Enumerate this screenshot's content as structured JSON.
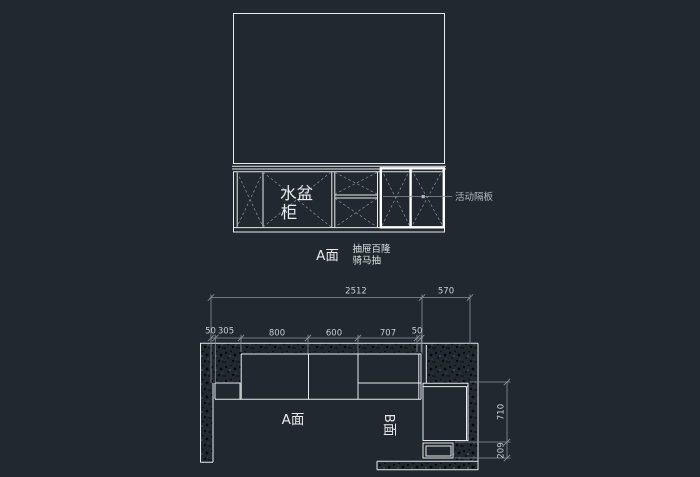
{
  "app": {
    "type": "cad-drawing-canvas",
    "background": "#212830"
  },
  "colors": {
    "background": "#212830",
    "line": "#e8eaec",
    "highlight": "#ffffff",
    "dim_line": "#8a919b",
    "dim_text": "#c9ced5",
    "annotation": "#b3bac2",
    "diagonal": "#7e8791"
  },
  "elevation": {
    "sink_cabinet_label_line1": "水盆",
    "sink_cabinet_label_line2": "柜",
    "face_label": "A面",
    "note_line1": "抽屉百隆",
    "note_line2": "骑马抽",
    "leader_label": "活动隔板"
  },
  "plan": {
    "face_a_label": "A面",
    "face_b_label": "B面",
    "dim_total": "2512",
    "dim_right": "570",
    "segments": [
      "50",
      "305",
      "800",
      "600",
      "707",
      "50"
    ],
    "dim_depth": "710",
    "dim_toe": "209"
  }
}
